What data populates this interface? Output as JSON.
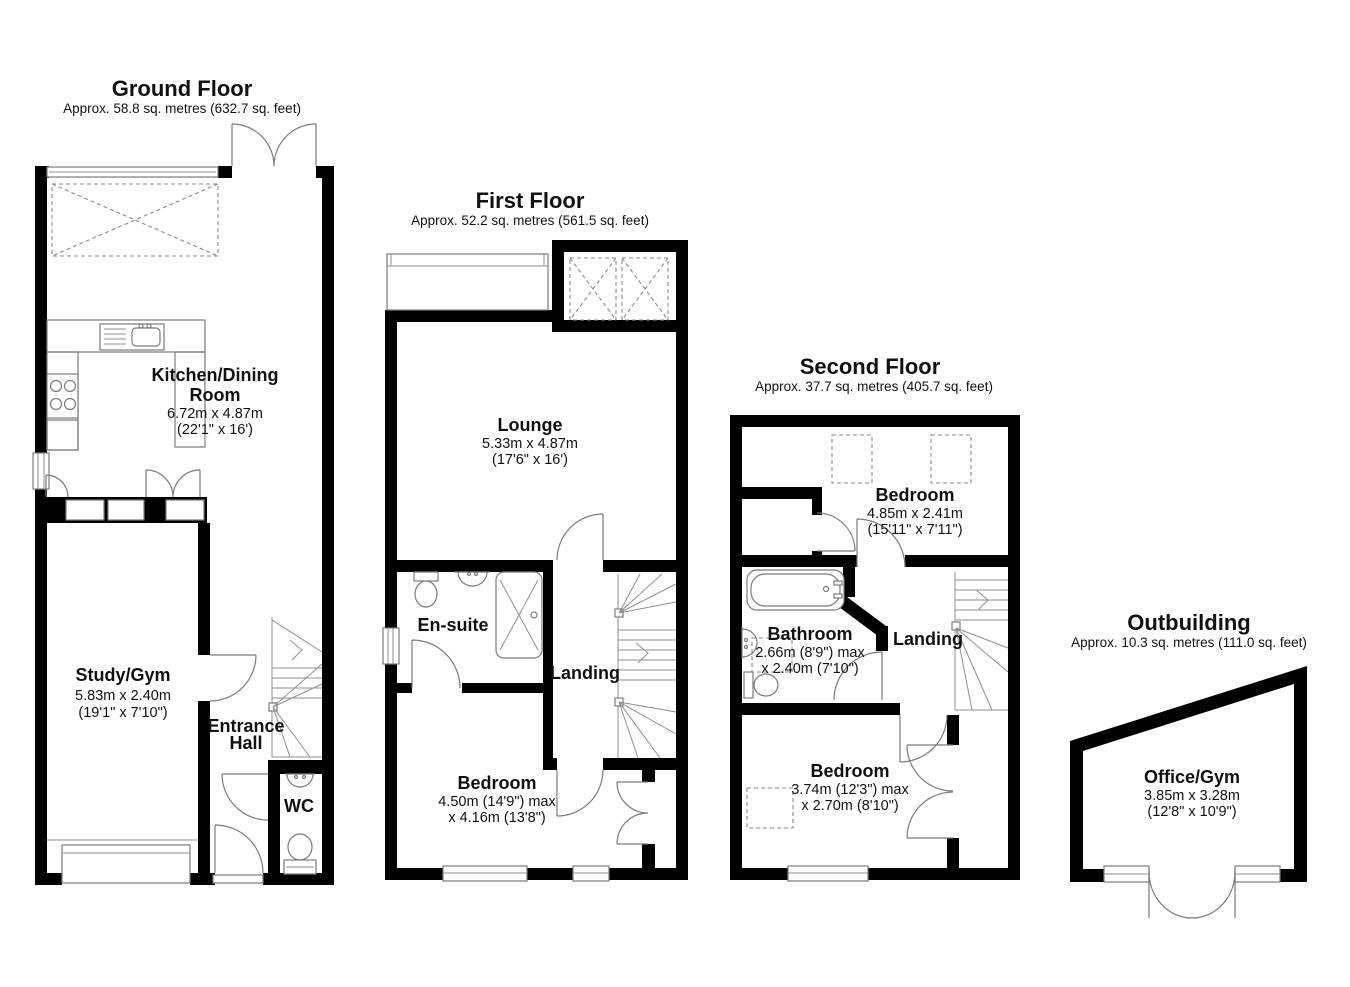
{
  "ground": {
    "title": "Ground Floor",
    "subtitle": "Approx. 58.8 sq. metres (632.7 sq. feet)",
    "kitchen_name_1": "Kitchen/Dining",
    "kitchen_name_2": "Room",
    "kitchen_dims_m": "6.72m x 4.87m",
    "kitchen_dims_ft": "(22'1\" x 16')",
    "study_name": "Study/Gym",
    "study_dims_m": "5.83m x 2.40m",
    "study_dims_ft": "(19'1\" x 7'10\")",
    "hall_name_1": "Entrance",
    "hall_name_2": "Hall",
    "wc_name": "WC"
  },
  "first": {
    "title": "First Floor",
    "subtitle": "Approx. 52.2 sq. metres (561.5 sq. feet)",
    "lounge_name": "Lounge",
    "lounge_dims_m": "5.33m x 4.87m",
    "lounge_dims_ft": "(17'6\" x 16')",
    "ensuite_name": "En-suite",
    "landing_name": "Landing",
    "bedroom_name": "Bedroom",
    "bedroom_dims_1": "4.50m (14'9\") max",
    "bedroom_dims_2": "x 4.16m (13'8\")"
  },
  "second": {
    "title": "Second Floor",
    "subtitle": "Approx. 37.7 sq. metres (405.7 sq. feet)",
    "bedroom1_name": "Bedroom",
    "bedroom1_dims_m": "4.85m x 2.41m",
    "bedroom1_dims_ft": "(15'11\" x 7'11\")",
    "bathroom_name": "Bathroom",
    "bathroom_dims_1": "2.66m (8'9\") max",
    "bathroom_dims_2": "x 2.40m (7'10\")",
    "landing_name": "Landing",
    "bedroom2_name": "Bedroom",
    "bedroom2_dims_1": "3.74m (12'3\") max",
    "bedroom2_dims_2": "x 2.70m (8'10\")"
  },
  "outbuilding": {
    "title": "Outbuilding",
    "subtitle": "Approx. 10.3 sq. metres (111.0 sq. feet)",
    "office_name": "Office/Gym",
    "office_dims_m": "3.85m x 3.28m",
    "office_dims_ft": "(12'8\" x 10'9\")"
  }
}
